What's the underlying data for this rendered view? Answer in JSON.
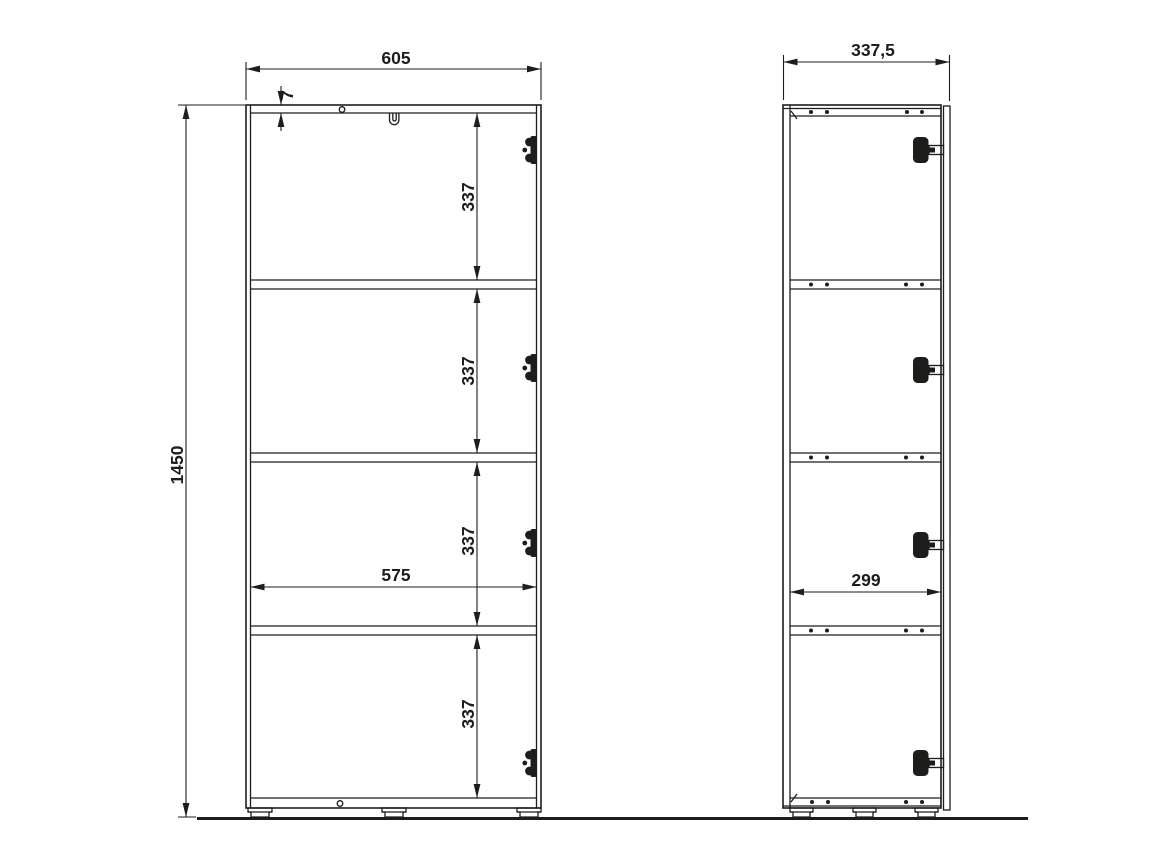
{
  "drawing": {
    "front_view": {
      "overall_width": "605",
      "top_panel_thickness": "7",
      "overall_height": "1450",
      "inner_width": "575",
      "shelf_spacings": [
        "337",
        "337",
        "337",
        "337"
      ]
    },
    "side_view": {
      "overall_depth": "337,5",
      "inner_depth": "299"
    },
    "colors": {
      "line": "#1d1d1b",
      "background": "#ffffff"
    }
  }
}
